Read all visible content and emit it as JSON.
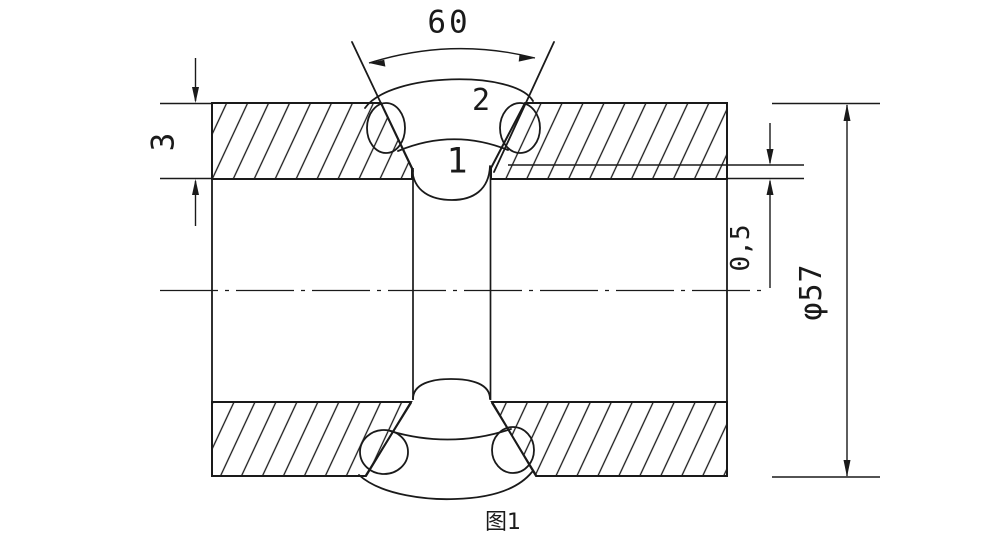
{
  "figure": {
    "caption": "图1",
    "weld_passes": {
      "pass1_label": "1",
      "pass2_label": "2"
    },
    "dimensions": {
      "groove_angle_deg": "60",
      "wall_thickness_mm": "3",
      "root_gap_mm": "0,5",
      "pipe_diameter": "φ57"
    },
    "colors": {
      "line": "#1a1a1a",
      "background": "#ffffff"
    }
  }
}
